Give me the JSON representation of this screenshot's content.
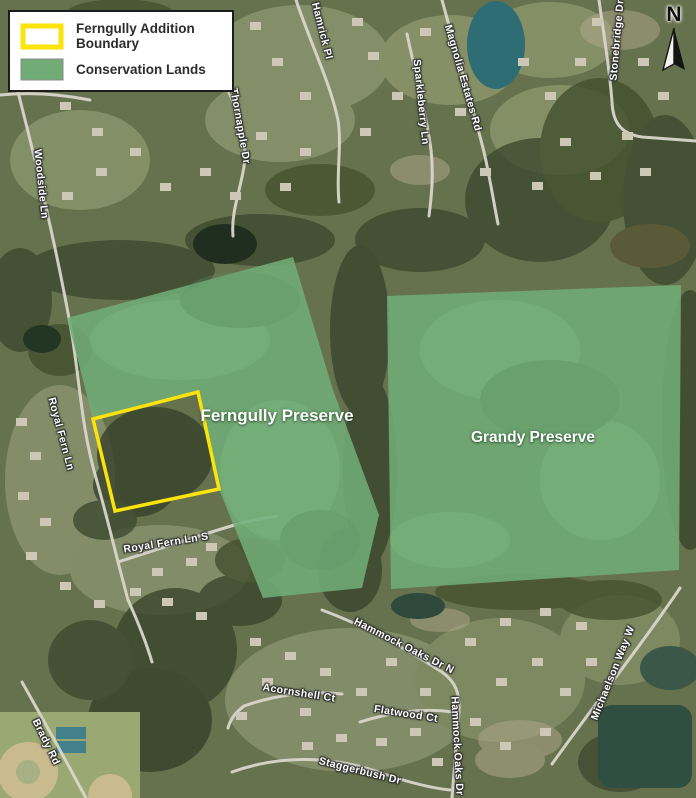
{
  "legend": {
    "items": [
      {
        "label": "Ferngully Addition Boundary",
        "swatch": "yellow-outline"
      },
      {
        "label": "Conservation Lands",
        "swatch": "green-fill"
      }
    ]
  },
  "north": {
    "label": "N"
  },
  "preserves": [
    {
      "name": "Ferngully Preserve"
    },
    {
      "name": "Grandy Preserve"
    }
  ],
  "streets": [
    {
      "name": "Woodside Ln"
    },
    {
      "name": "Thornapple Dr"
    },
    {
      "name": "Hamrick Pl"
    },
    {
      "name": "Sparkleberry Ln"
    },
    {
      "name": "Magnolia Estates Rd"
    },
    {
      "name": "Stonebridge Dr"
    },
    {
      "name": "Royal Fern Ln"
    },
    {
      "name": "Royal Fern Ln S"
    },
    {
      "name": "Hammock Oaks Dr N"
    },
    {
      "name": "Acornshell Ct"
    },
    {
      "name": "Flatwood Ct"
    },
    {
      "name": "Hammock Oaks Dr"
    },
    {
      "name": "Michaelson Way W"
    },
    {
      "name": "Staggerbush Dr"
    },
    {
      "name": "Brady Rd"
    }
  ],
  "colors": {
    "conservation_green": "#71ac77",
    "boundary_yellow": "#fbe30c"
  }
}
